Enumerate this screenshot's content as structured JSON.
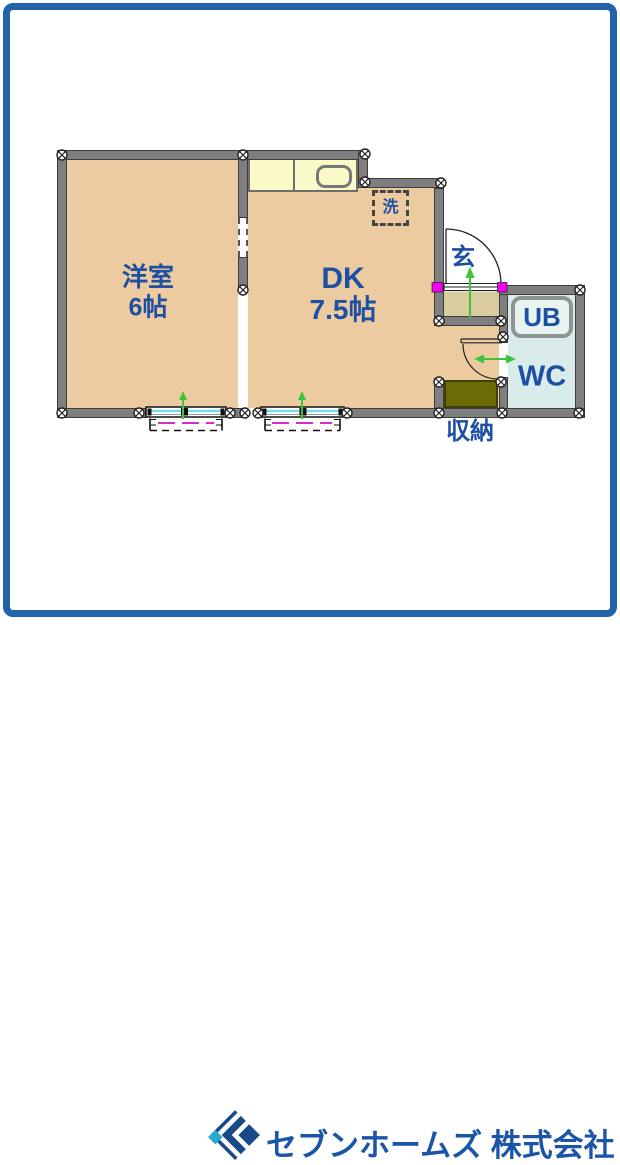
{
  "floorplan": {
    "rooms": {
      "western_room": {
        "name": "洋室",
        "size": "6帖"
      },
      "dining_kitchen": {
        "name": "DK",
        "size": "7.5帖"
      },
      "entrance": {
        "label": "玄"
      },
      "unit_bath": {
        "label": "UB"
      },
      "toilet": {
        "label": "WC"
      },
      "storage": {
        "label": "収納"
      },
      "washer": {
        "label": "洗"
      }
    },
    "colors": {
      "room_floor": "#ECCBA0",
      "entrance_floor": "#D9CC9F",
      "kitchen_counter": "#FAFAC8",
      "bath_floor": "#D9EBEA",
      "storage_fill": "#6C6C07",
      "wall": "#7F7F7F",
      "label_text": "#1D4FA2",
      "frame_border": "#2263AB",
      "door_marker": "#F201F2",
      "direction_arrow": "#3CC53C",
      "window_glass": "#77DCE8",
      "window_rail": "#D62CC9"
    }
  },
  "footer": {
    "company_name": "セブンホームズ 株式会社",
    "logo": "diamond-logo"
  }
}
